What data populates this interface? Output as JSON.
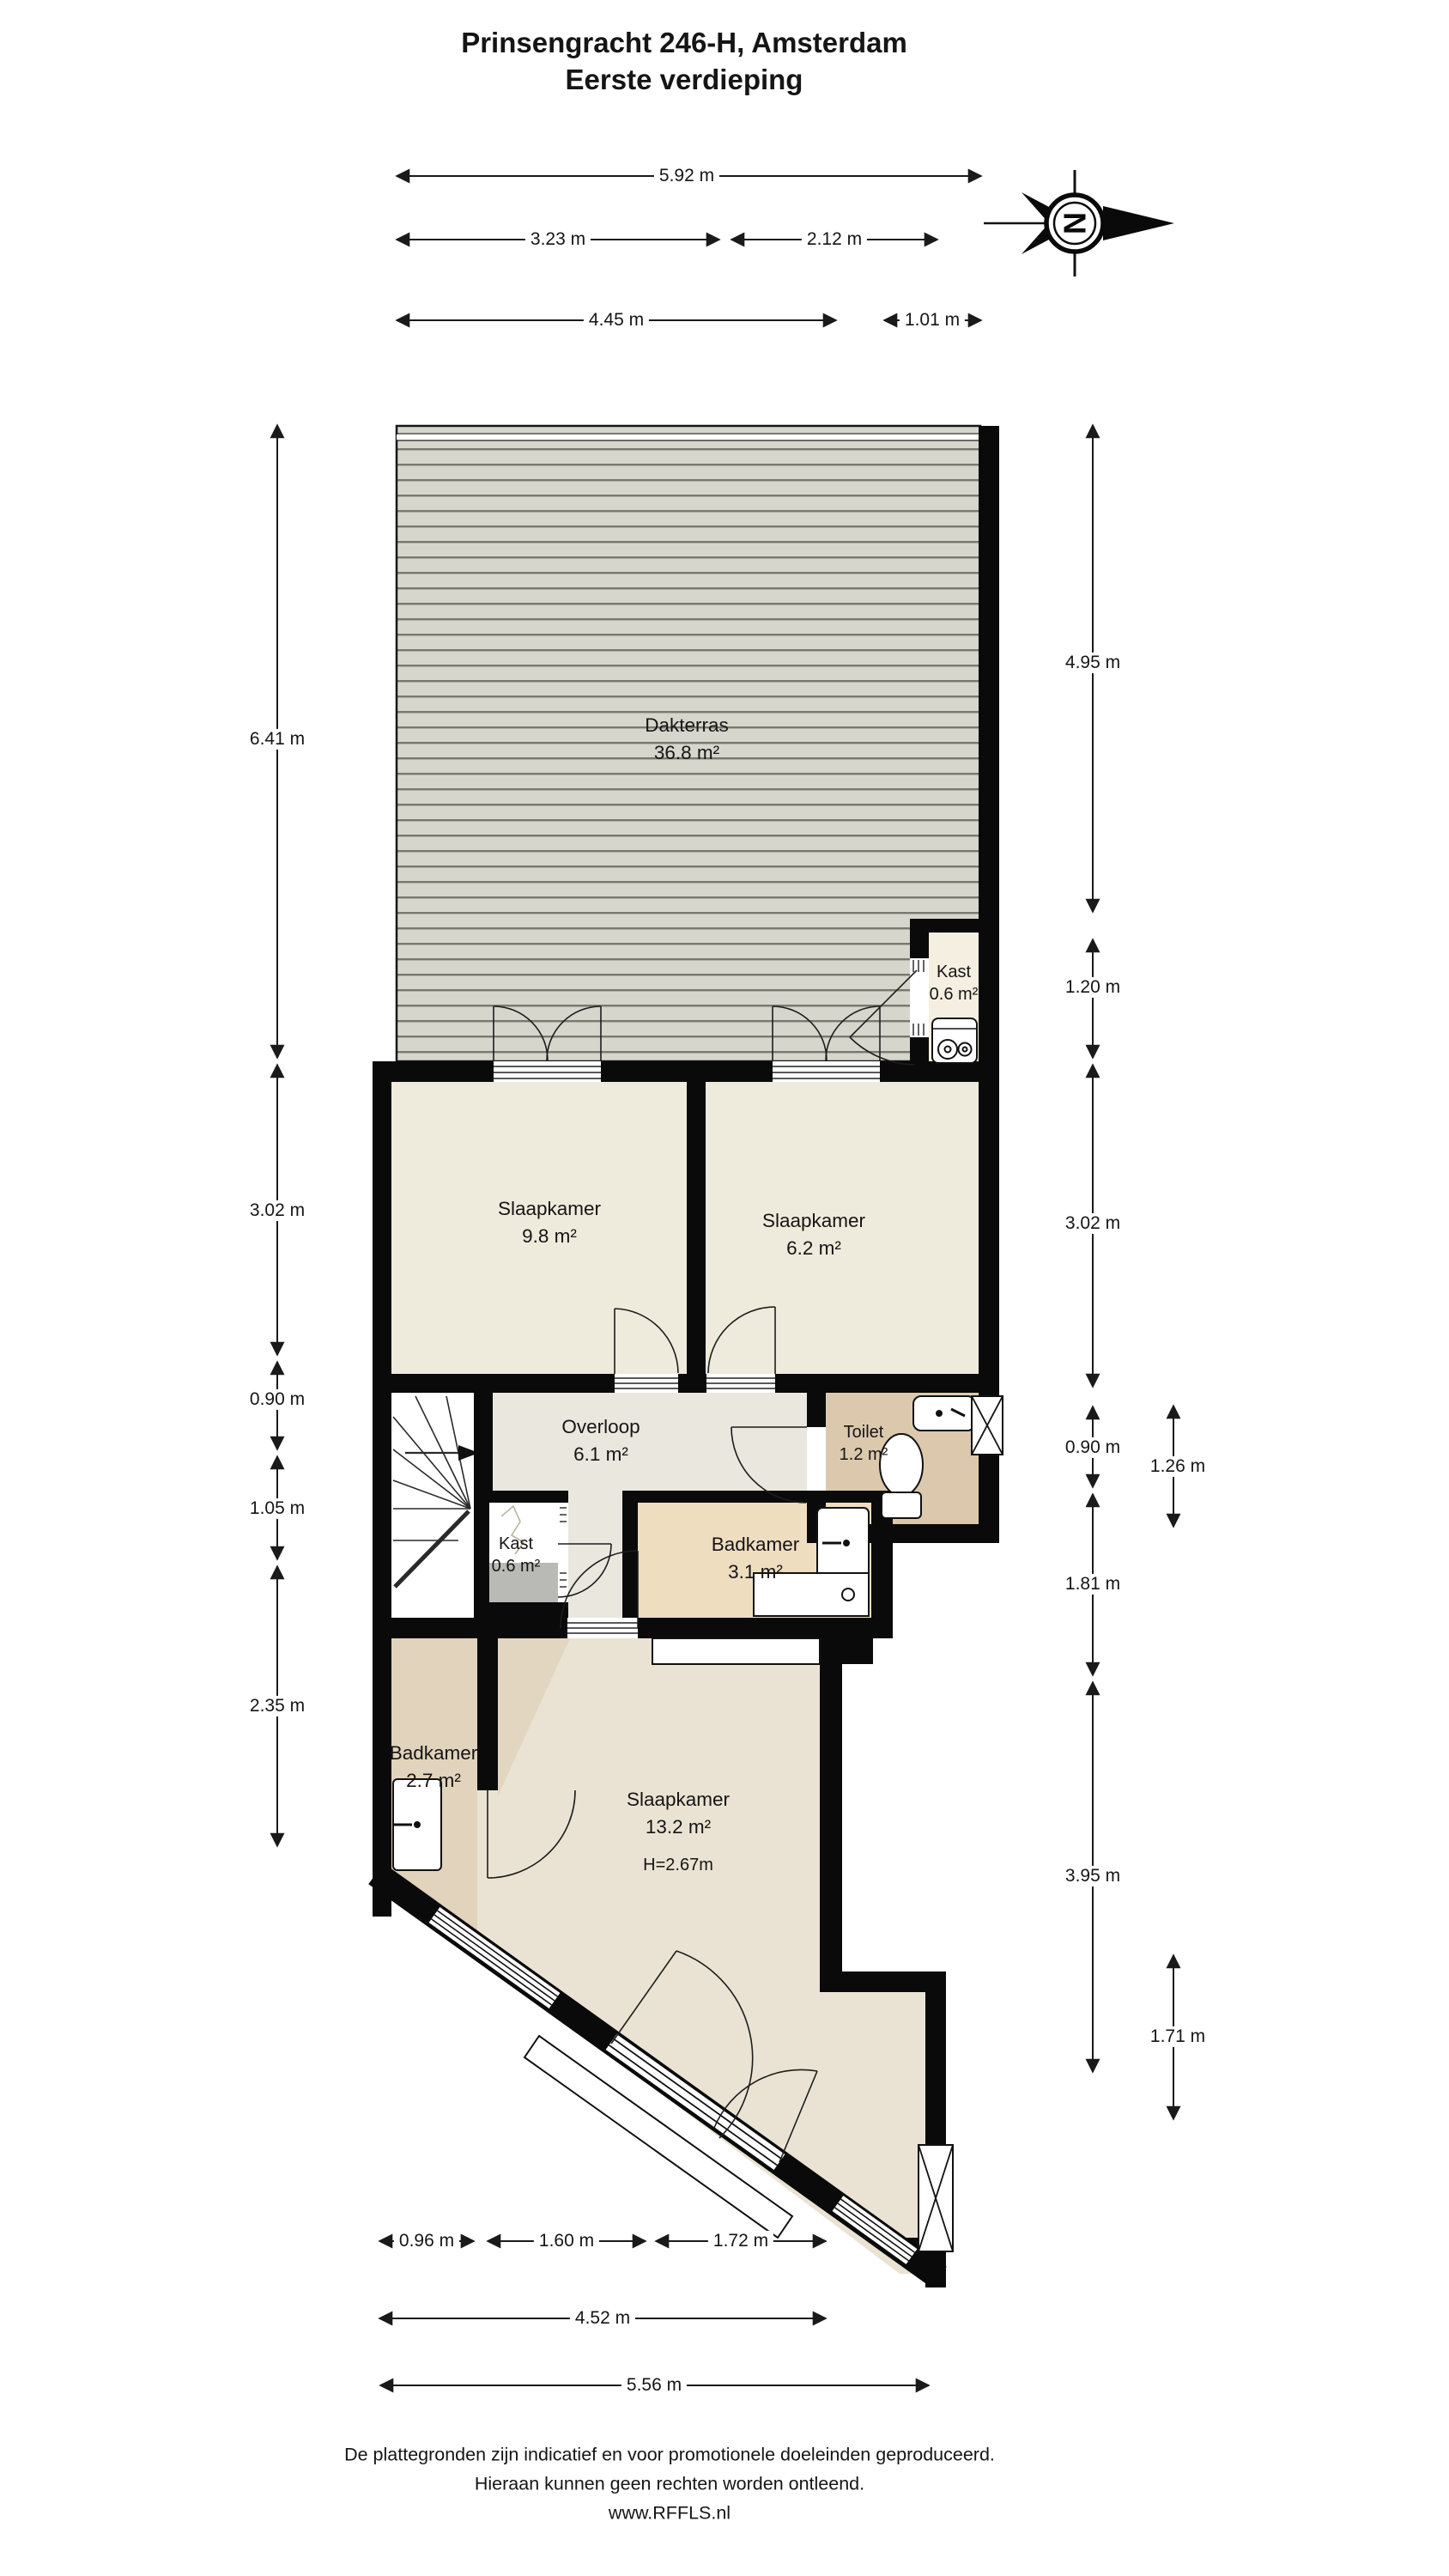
{
  "title": {
    "line1": "Prinsengracht 246-H, Amsterdam",
    "line2": "Eerste verdieping"
  },
  "compass": {
    "letter": "N"
  },
  "rooms": {
    "dakterras": {
      "name": "Dakterras",
      "area": "36.8 m²"
    },
    "kast_boven": {
      "name": "Kast",
      "area": "0.6 m²"
    },
    "slaapkamer1": {
      "name": "Slaapkamer",
      "area": "9.8 m²"
    },
    "slaapkamer2": {
      "name": "Slaapkamer",
      "area": "6.2 m²"
    },
    "overloop": {
      "name": "Overloop",
      "area": "6.1 m²"
    },
    "toilet": {
      "name": "Toilet",
      "area": "1.2 m²"
    },
    "kast_midden": {
      "name": "Kast",
      "area": "0.6 m²"
    },
    "badkamer1": {
      "name": "Badkamer",
      "area": "3.1 m²"
    },
    "badkamer2": {
      "name": "Badkamer",
      "area": "2.7 m²"
    },
    "slaapkamer3": {
      "name": "Slaapkamer",
      "area": "13.2 m²",
      "height_note": "H=2.67m"
    }
  },
  "dimensions": {
    "top": [
      {
        "label": "5.92 m"
      },
      {
        "label": "3.23 m"
      },
      {
        "label": "2.12 m"
      },
      {
        "label": "4.45 m"
      },
      {
        "label": "1.01 m"
      }
    ],
    "left": [
      {
        "label": "6.41 m"
      },
      {
        "label": "3.02 m"
      },
      {
        "label": "0.90 m"
      },
      {
        "label": "1.05 m"
      },
      {
        "label": "2.35 m"
      }
    ],
    "right": [
      {
        "label": "4.95 m"
      },
      {
        "label": "1.20 m"
      },
      {
        "label": "3.02 m"
      },
      {
        "label": "0.90 m"
      },
      {
        "label": "1.81 m"
      },
      {
        "label": "3.95 m"
      }
    ],
    "right_inner": [
      {
        "label": "1.26 m"
      },
      {
        "label": "1.71 m"
      }
    ],
    "bottom": [
      {
        "label": "0.96 m"
      },
      {
        "label": "1.60 m"
      },
      {
        "label": "1.72 m"
      },
      {
        "label": "4.52 m"
      },
      {
        "label": "5.56 m"
      }
    ]
  },
  "footer": {
    "line1": "De plattegronden zijn indicatief en voor promotionele doeleinden geproduceerd.",
    "line2": "Hieraan kunnen geen rechten worden ontleend.",
    "line3": "www.RFFLS.nl"
  },
  "colors": {
    "wall": "#0a0a0a",
    "room_cream": "#efebdc",
    "hall": "#e9e7de",
    "toilet_floor": "#dcc9ad",
    "bath1_floor": "#efddc0",
    "bath2_floor": "#e1d3bc",
    "bedroom3_floor": "#eae3d3",
    "terrace": "#d7d6cc",
    "terrace_line": "#78786f",
    "closet_grey": "#b9b9b5"
  }
}
